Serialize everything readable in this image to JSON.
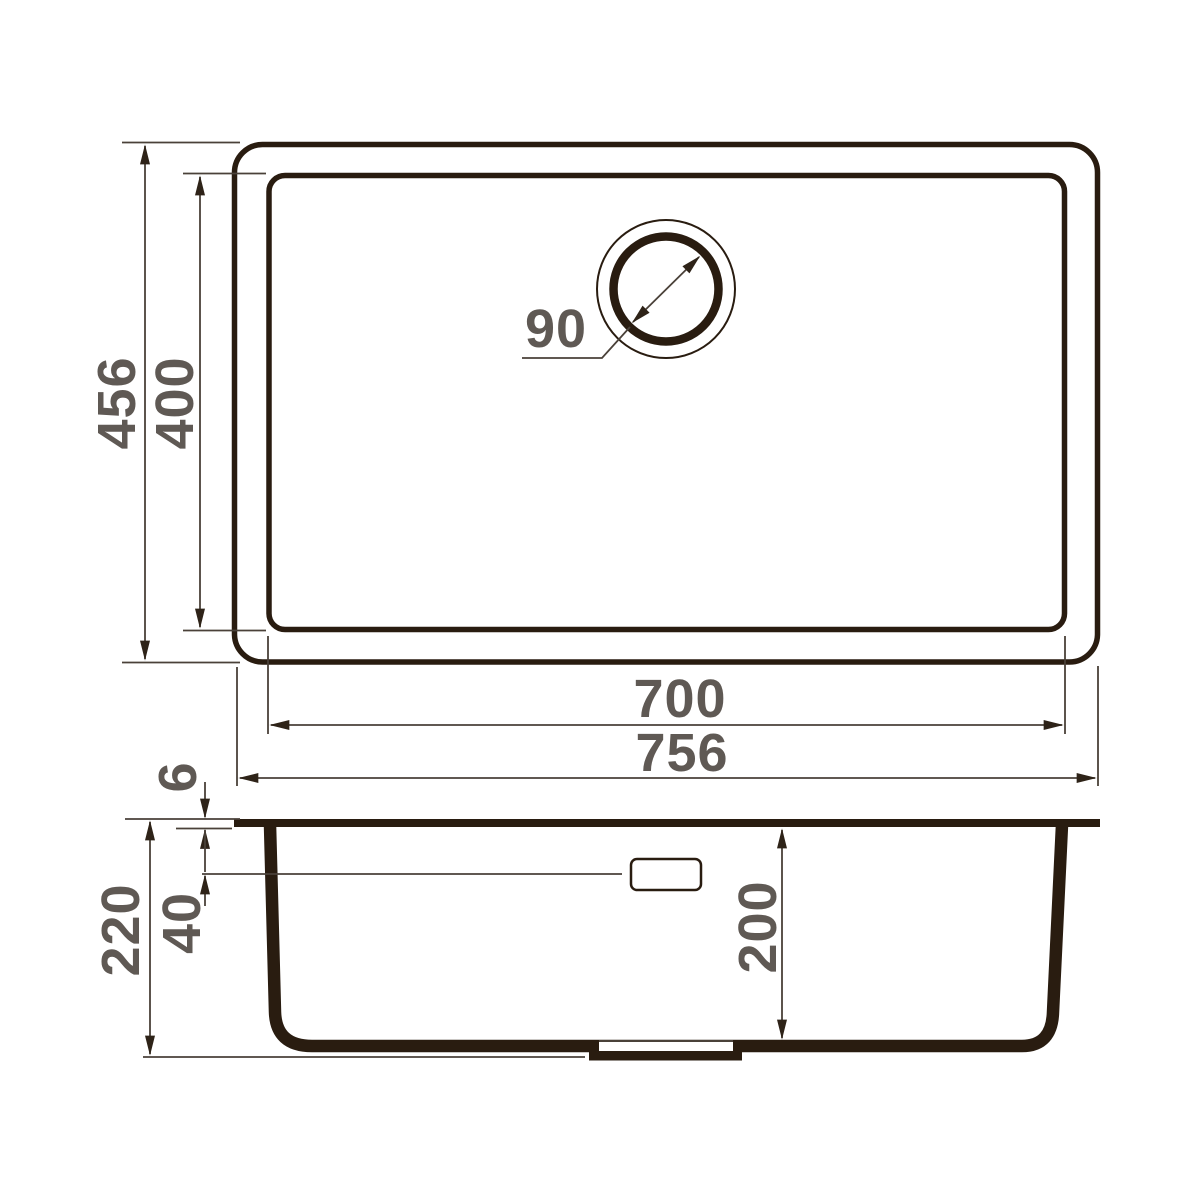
{
  "dimensions": {
    "overall_width": "756",
    "overall_depth": "456",
    "bowl_width": "700",
    "bowl_depth": "400",
    "drain_diameter": "90",
    "rim_thickness": "6",
    "overflow_level": "40",
    "total_height": "220",
    "bowl_height": "200"
  },
  "colors": {
    "ink": "#291c10",
    "line": "#4a4139",
    "arrow": "#2e2318",
    "label": "#5f5954",
    "bg": "#ffffff"
  }
}
